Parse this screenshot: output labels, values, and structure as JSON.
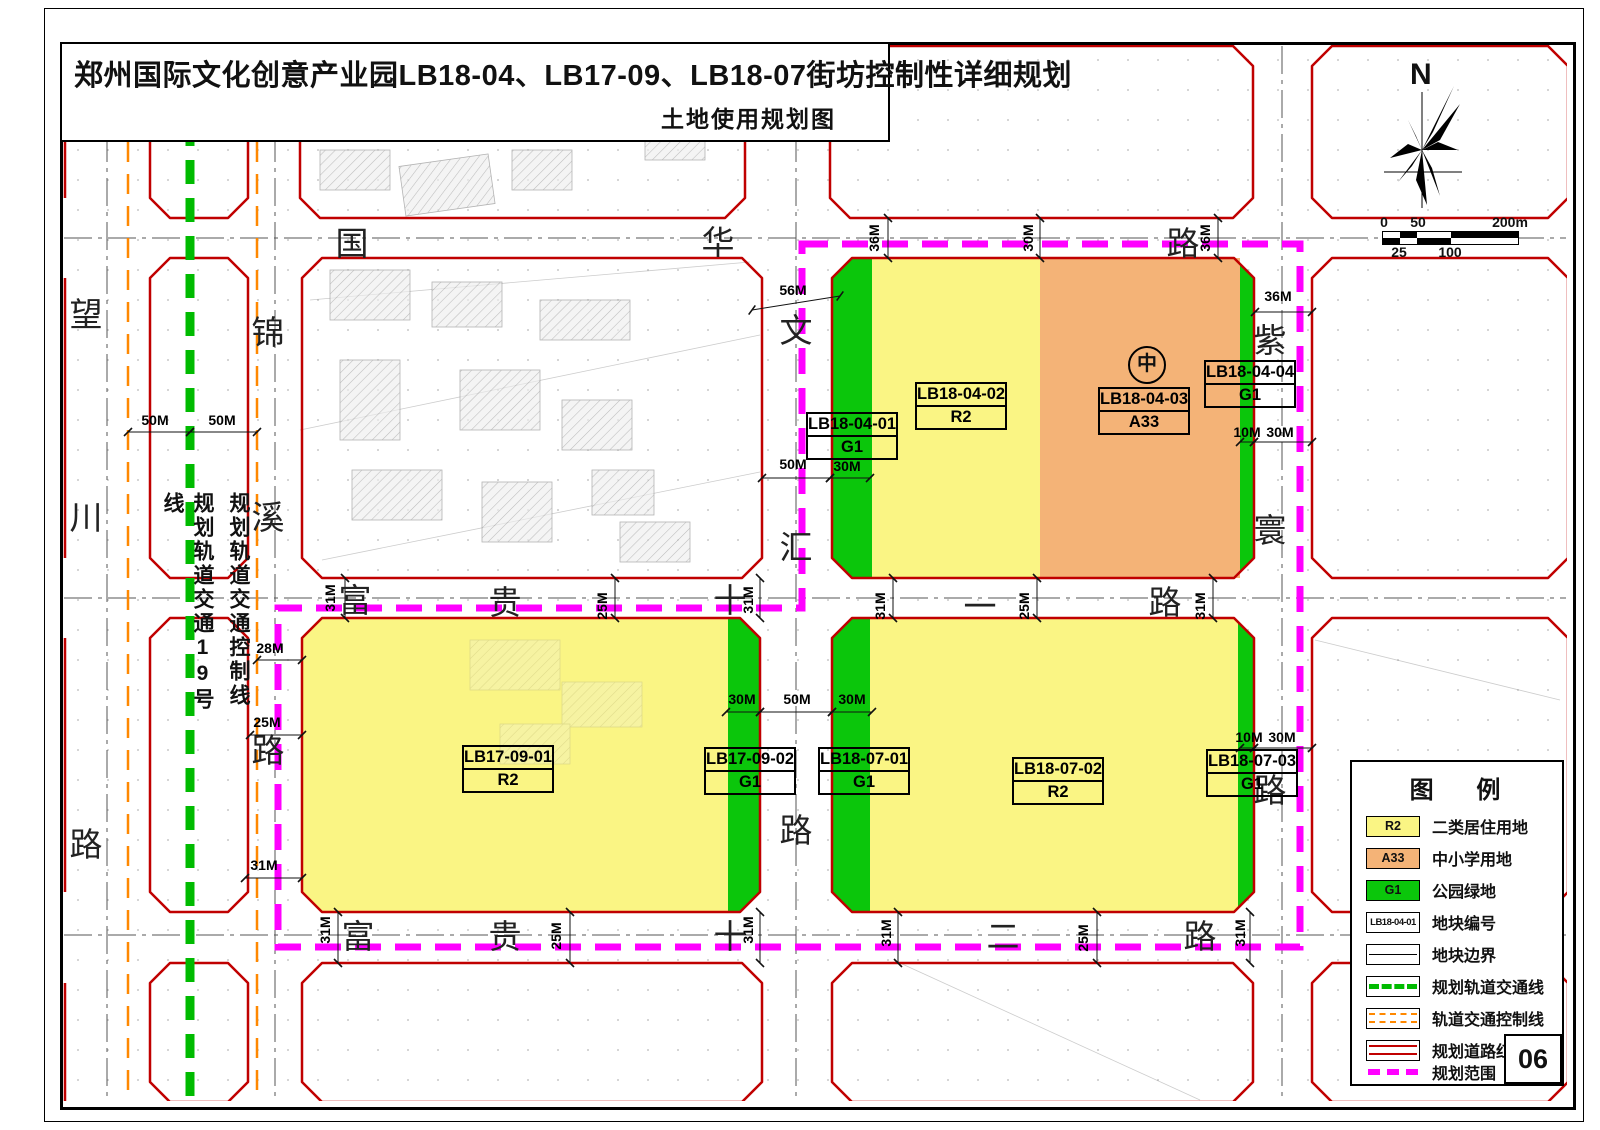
{
  "title": "郑州国际文化创意产业园LB18-04、LB17-09、LB18-07街坊控制性详细规划",
  "subtitle": "土地使用规划图",
  "north_label": "N",
  "scale_bar": {
    "top": [
      "0",
      "50",
      "200m"
    ],
    "bottom": [
      "25",
      "100"
    ]
  },
  "colors": {
    "r2": "#FAF584",
    "a33": "#F4B377",
    "g1": "#0BC60B",
    "red": "#C00000",
    "mag": "#FF00FF",
    "rail-green": "#00BB00",
    "rail-orange": "#FF8800"
  },
  "roads": {
    "wangchuan": [
      "望",
      "川",
      "路"
    ],
    "jinxi": [
      "锦",
      "溪",
      "路"
    ],
    "guohua": [
      "国",
      "华",
      "路"
    ],
    "fugui11": [
      "富",
      "贵",
      "十",
      "一",
      "路"
    ],
    "fugui12": [
      "富",
      "贵",
      "十",
      "二",
      "路"
    ],
    "wenhui": [
      "文",
      "汇",
      "路"
    ],
    "zihuan": [
      "紫",
      "寰",
      "路"
    ]
  },
  "rail_labels": {
    "line19": "规划轨道交通19号线",
    "control": "规划轨道交通控制线"
  },
  "parcels": [
    {
      "code": "LB18-04-01",
      "type": "G1"
    },
    {
      "code": "LB18-04-02",
      "type": "R2"
    },
    {
      "code": "LB18-04-03",
      "type": "A33"
    },
    {
      "code": "LB18-04-04",
      "type": "G1"
    },
    {
      "code": "LB17-09-01",
      "type": "R2"
    },
    {
      "code": "LB17-09-02",
      "type": "G1"
    },
    {
      "code": "LB18-07-01",
      "type": "G1"
    },
    {
      "code": "LB18-07-02",
      "type": "R2"
    },
    {
      "code": "LB18-07-03",
      "type": "G1"
    }
  ],
  "school_symbol": "中",
  "dims": [
    "50M",
    "50M",
    "28M",
    "25M",
    "31M",
    "56M",
    "36M",
    "30M",
    "36M",
    "36M",
    "50M",
    "30M",
    "10M",
    "30M",
    "31M",
    "25M",
    "31M",
    "31M",
    "25M",
    "31M",
    "30M",
    "50M",
    "30M",
    "10M",
    "30M",
    "31M",
    "25M",
    "31M",
    "31M",
    "25M",
    "31M"
  ],
  "legend": {
    "title": "图 例",
    "items": [
      {
        "swatch": "R2",
        "label": "二类居住用地"
      },
      {
        "swatch": "A33",
        "label": "中小学用地"
      },
      {
        "swatch": "G1",
        "label": "公园绿地"
      },
      {
        "swatch": "LB18-04-01",
        "label": "地块编号"
      },
      {
        "swatch": "",
        "label": "地块边界"
      },
      {
        "swatch": "",
        "label": "规划轨道交通线"
      },
      {
        "swatch": "",
        "label": "轨道交通控制线"
      },
      {
        "swatch": "",
        "label": "规划道路红线"
      },
      {
        "swatch": "",
        "label": "规划范围"
      }
    ]
  },
  "page_number": "06"
}
